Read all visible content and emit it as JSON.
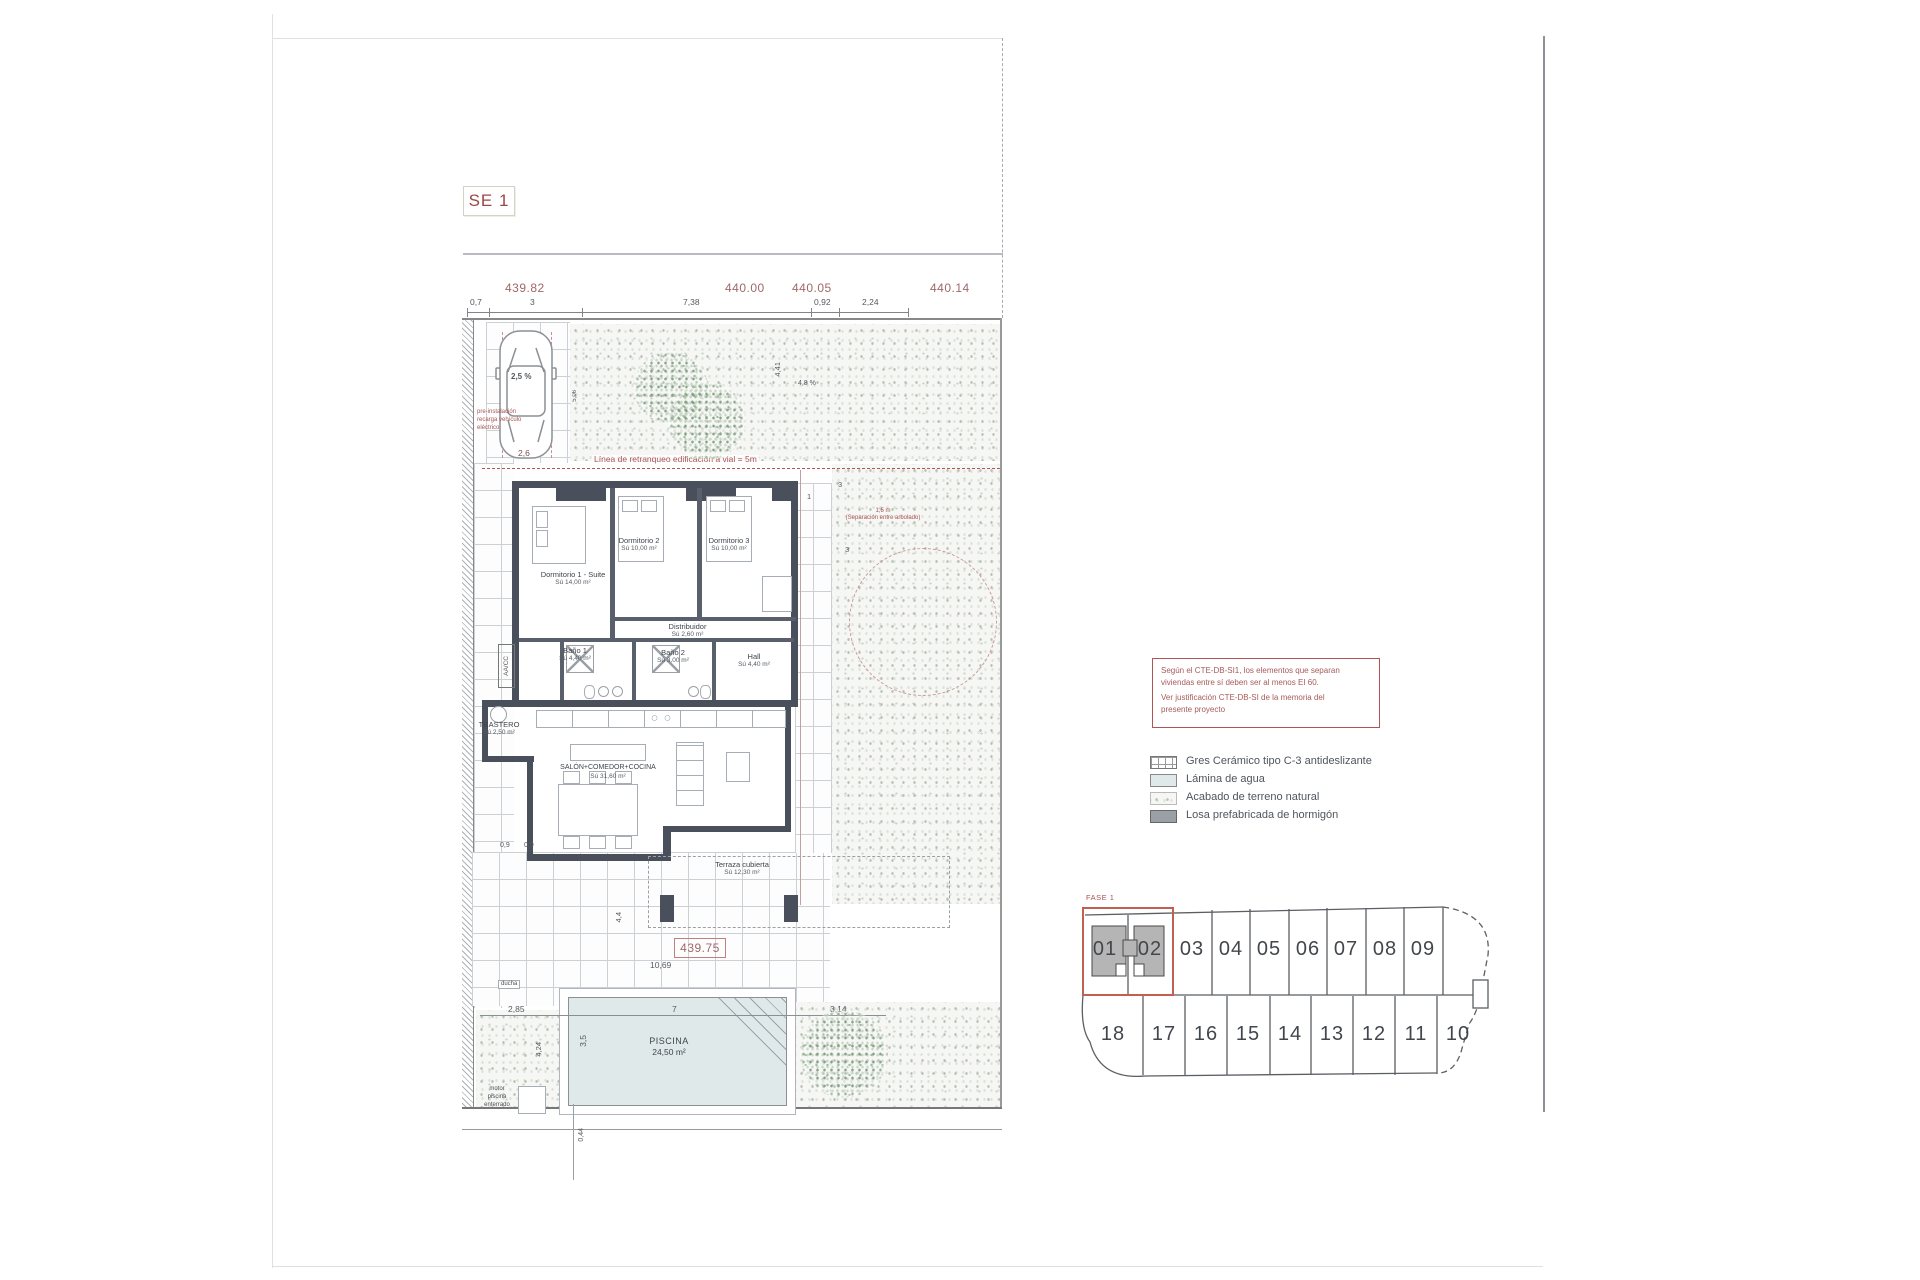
{
  "sheet": {
    "title_box": "SE 1"
  },
  "top_dims": {
    "elev1": "439.82",
    "elev2": "440.00",
    "elev3": "440.05",
    "elev4": "440.14",
    "d1": "0,7",
    "d2": "3",
    "d3": "7,38",
    "d4": "0,92",
    "d5": "2,24"
  },
  "site": {
    "retranqueo": "Línea de retranqueo edificación a vial = 5m",
    "ev1": "pre-instalación",
    "ev2": "recarga vehículo",
    "ev3": "eléctrico",
    "car_slope": "2,5 %",
    "car_width": "2,6",
    "car_length": "5,06",
    "slope_right": "4,8 %",
    "dim_441": "4,41",
    "sep1": "1,5 m",
    "sep2": "(Separación entre arbolado)",
    "dim_3a": "3",
    "dim_1": "1",
    "dim_3b": "3"
  },
  "rooms": {
    "dorm1": {
      "name": "Dormitorio 1 - Suite",
      "area": "Sú 14,00 m²"
    },
    "dorm2": {
      "name": "Dormitorio 2",
      "area": "Sú 10,00 m²"
    },
    "dorm3": {
      "name": "Dormitorio 3",
      "area": "Sú 10,00 m²"
    },
    "distribuidor": {
      "name": "Distribuidor",
      "area": "Sú 2,60 m²"
    },
    "bano1": {
      "name": "Baño 1",
      "area": "Sú 4,40 m²"
    },
    "bano2": {
      "name": "Baño 2",
      "area": "Sú 3,00 m²"
    },
    "hall": {
      "name": "Hall",
      "area": "Sú 4,40 m²"
    },
    "trastero": {
      "name": "TRASTERO",
      "area": "Sú 2,50 m²"
    },
    "salon": {
      "name": "SALÓN+COMEDOR+COCINA",
      "area": "Sú 31,60 m²"
    },
    "terraza": {
      "name": "Terraza cubierta",
      "area": "Sú 12,30 m²"
    },
    "aacc": "AA/CC"
  },
  "lower": {
    "d09a": "0,9",
    "d09b": "0,9",
    "d44": "4,4",
    "elev": "439.75",
    "d1069": "10,69",
    "d285": "2,85",
    "d7": "7",
    "d314": "3,14",
    "d35": "3,5",
    "d424": "4,24",
    "d044": "0,44",
    "ducha": "ducha",
    "motor1": "motor",
    "motor2": "piscina",
    "motor3": "enterrado",
    "pool_name": "PISCINA",
    "pool_area": "24,50 m²"
  },
  "note_box": {
    "l1": "Según el CTE-DB-SI1, los elementos que separan",
    "l2": "viviendas entre sí deben ser al menos EI 60.",
    "l3": "Ver justificación CTE-DB-SI de la memoria del",
    "l4": "presente proyecto"
  },
  "legend": {
    "items": [
      {
        "label": "Gres Cerámico tipo C-3 antideslizante"
      },
      {
        "label": "Lámina de agua"
      },
      {
        "label": "Acabado de terreno natural"
      },
      {
        "label": "Losa prefabricada de hormigón"
      }
    ]
  },
  "plots": {
    "fase": "FASE 1",
    "top": [
      "01",
      "02",
      "03",
      "04",
      "05",
      "06",
      "07",
      "08",
      "09"
    ],
    "bottom": [
      "18",
      "17",
      "16",
      "15",
      "14",
      "13",
      "12",
      "11",
      "10"
    ]
  },
  "colors": {
    "accent_red": "#a85454",
    "wall": "#4a505b",
    "water": "#dfe9ea"
  }
}
